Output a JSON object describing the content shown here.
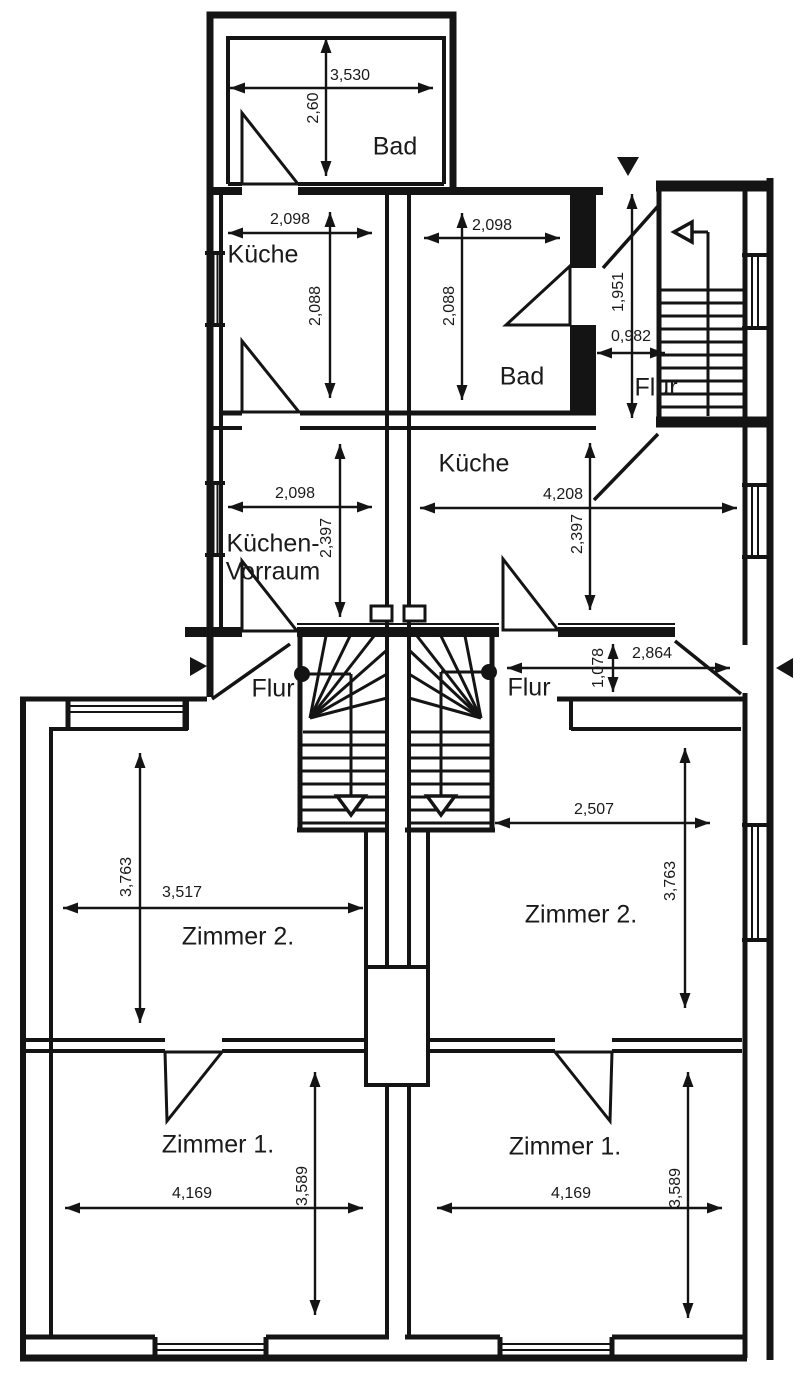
{
  "rooms": {
    "bad_top": "Bad",
    "kueche_left": "Küche",
    "bad_middle": "Bad",
    "flur_top": "Flur",
    "kueche_right": "Küche",
    "kuechenvorraum_line1": "Küchen-",
    "kuechenvorraum_line2": "Vorraum",
    "flur_left": "Flur",
    "flur_right": "Flur",
    "zimmer2_left": "Zimmer 2.",
    "zimmer2_right": "Zimmer 2.",
    "zimmer1_left": "Zimmer 1.",
    "zimmer1_right": "Zimmer 1."
  },
  "dims": {
    "bad_top_width": "3,530",
    "bad_top_height": "2,60",
    "kueche_left_width": "2,098",
    "kueche_left_height": "2,088",
    "bad_middle_width": "2,098",
    "bad_middle_height": "2,088",
    "flur_top_height": "1,951",
    "flur_top_width": "0,982",
    "vorraum_width": "2,098",
    "vorraum_height": "2,397",
    "kueche_right_width": "4,208",
    "kueche_right_height": "2,397",
    "flur_right_width": "2,864",
    "flur_right_height": "1,078",
    "zimmer2_left_width": "3,517",
    "zimmer2_left_height": "3,763",
    "zimmer2_right_width": "2,507",
    "zimmer2_right_height": "3,763",
    "zimmer1_left_width": "4,169",
    "zimmer1_left_height": "3,589",
    "zimmer1_right_width": "4,169",
    "zimmer1_right_height": "3,589"
  },
  "colors": {
    "ink": "#141414",
    "paper": "#ffffff"
  }
}
